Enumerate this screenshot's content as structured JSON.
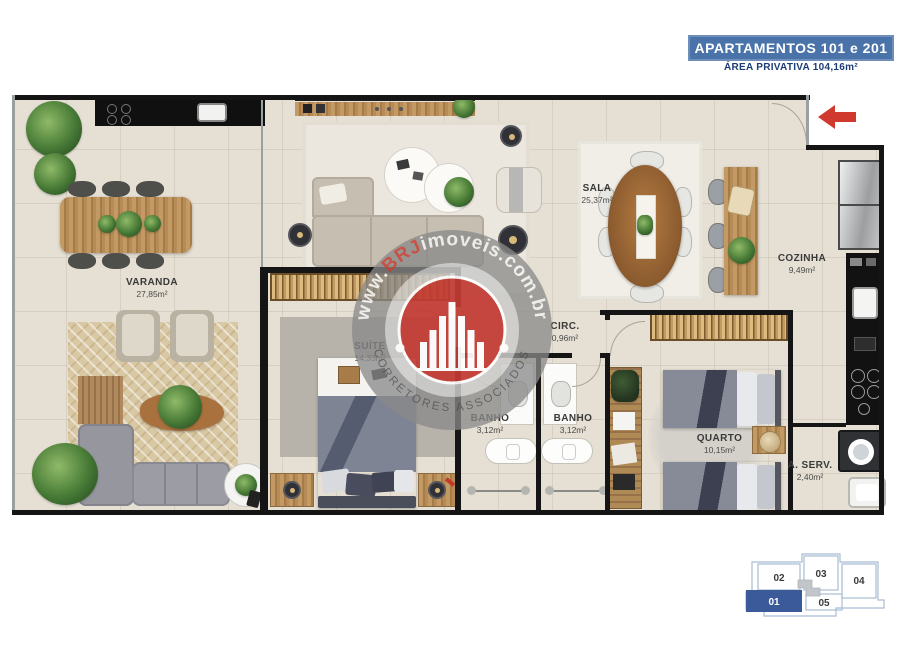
{
  "header": {
    "title": "APARTAMENTOS 101 e 201",
    "subtitle": "ÁREA PRIVATIVA 104,16m²"
  },
  "rooms": [
    {
      "name": "VARANDA",
      "area": "27,85m²"
    },
    {
      "name": "SALA",
      "area": "25,37m²"
    },
    {
      "name": "COZINHA",
      "area": "9,49m²"
    },
    {
      "name": "CIRC.",
      "area": "0,96m²"
    },
    {
      "name": "SUÍTE",
      "area": "14,33m²"
    },
    {
      "name": "BANHO",
      "area": "3,12m²"
    },
    {
      "name": "BANHO",
      "area": "3,12m²"
    },
    {
      "name": "QUARTO",
      "area": "10,15m²"
    },
    {
      "name": "A. SERV.",
      "area": "2,40m²"
    }
  ],
  "watermark": {
    "url_prefix": "www.",
    "url_brand": "BRJ",
    "url_suffix": "imoveis.com.br",
    "footer": "CORRETORES ASSOCIADOS"
  },
  "keyplan": {
    "units": [
      {
        "label": "02",
        "highlighted": false
      },
      {
        "label": "03",
        "highlighted": false
      },
      {
        "label": "04",
        "highlighted": false
      },
      {
        "label": "01",
        "highlighted": true
      },
      {
        "label": "05",
        "highlighted": false
      }
    ]
  },
  "icons": {
    "entry_arrow": "left-arrow",
    "logo_center": "building-skyline"
  },
  "colors": {
    "badge_blue": "#4a73a9",
    "subtitle_navy": "#1c3c74",
    "wall_black": "#151515",
    "floor_beige": "#e6e0d4",
    "logo_red": "#c23b33",
    "keyplan_highlight": "#3a5a99",
    "keyplan_outline": "#a9bcd3",
    "entry_arrow_red": "#d03a2e"
  }
}
